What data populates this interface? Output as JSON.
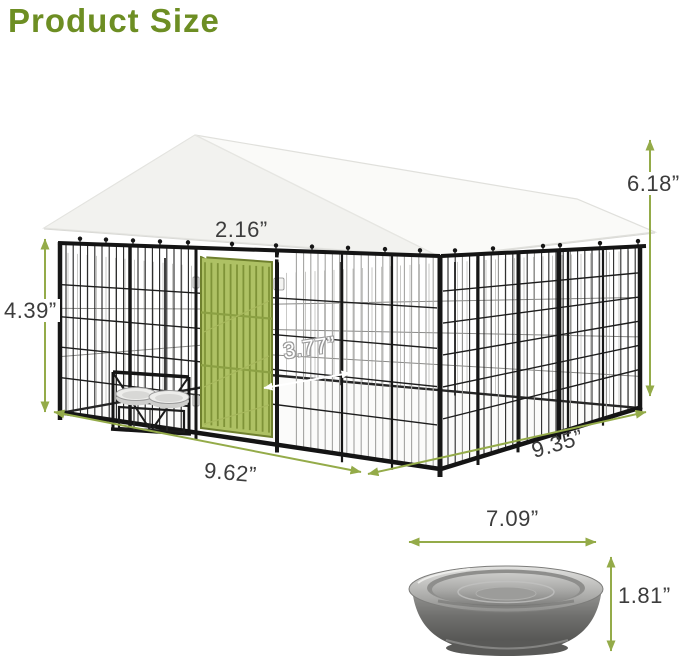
{
  "title": "Product Size",
  "colors": {
    "title_green": "#6d8e23",
    "arrow_green": "#94ab49",
    "dimension_text": "#3c3c3c",
    "door_green": "#aec164",
    "canopy_white": "#fafaf8",
    "frame_black": "#141414"
  },
  "kennel": {
    "description": "outdoor dog kennel with canopy roof, green door and feeder bowls",
    "dimensions": {
      "total_height": "6.18”",
      "door_width": "2.16”",
      "panel_height": "4.39”",
      "inner_depth": "3.77”",
      "front_width": "9.62”",
      "side_width": "9.35”"
    }
  },
  "bowl": {
    "description": "stainless steel feeding bowl",
    "dimensions": {
      "diameter": "7.09”",
      "height": "1.81”"
    }
  }
}
